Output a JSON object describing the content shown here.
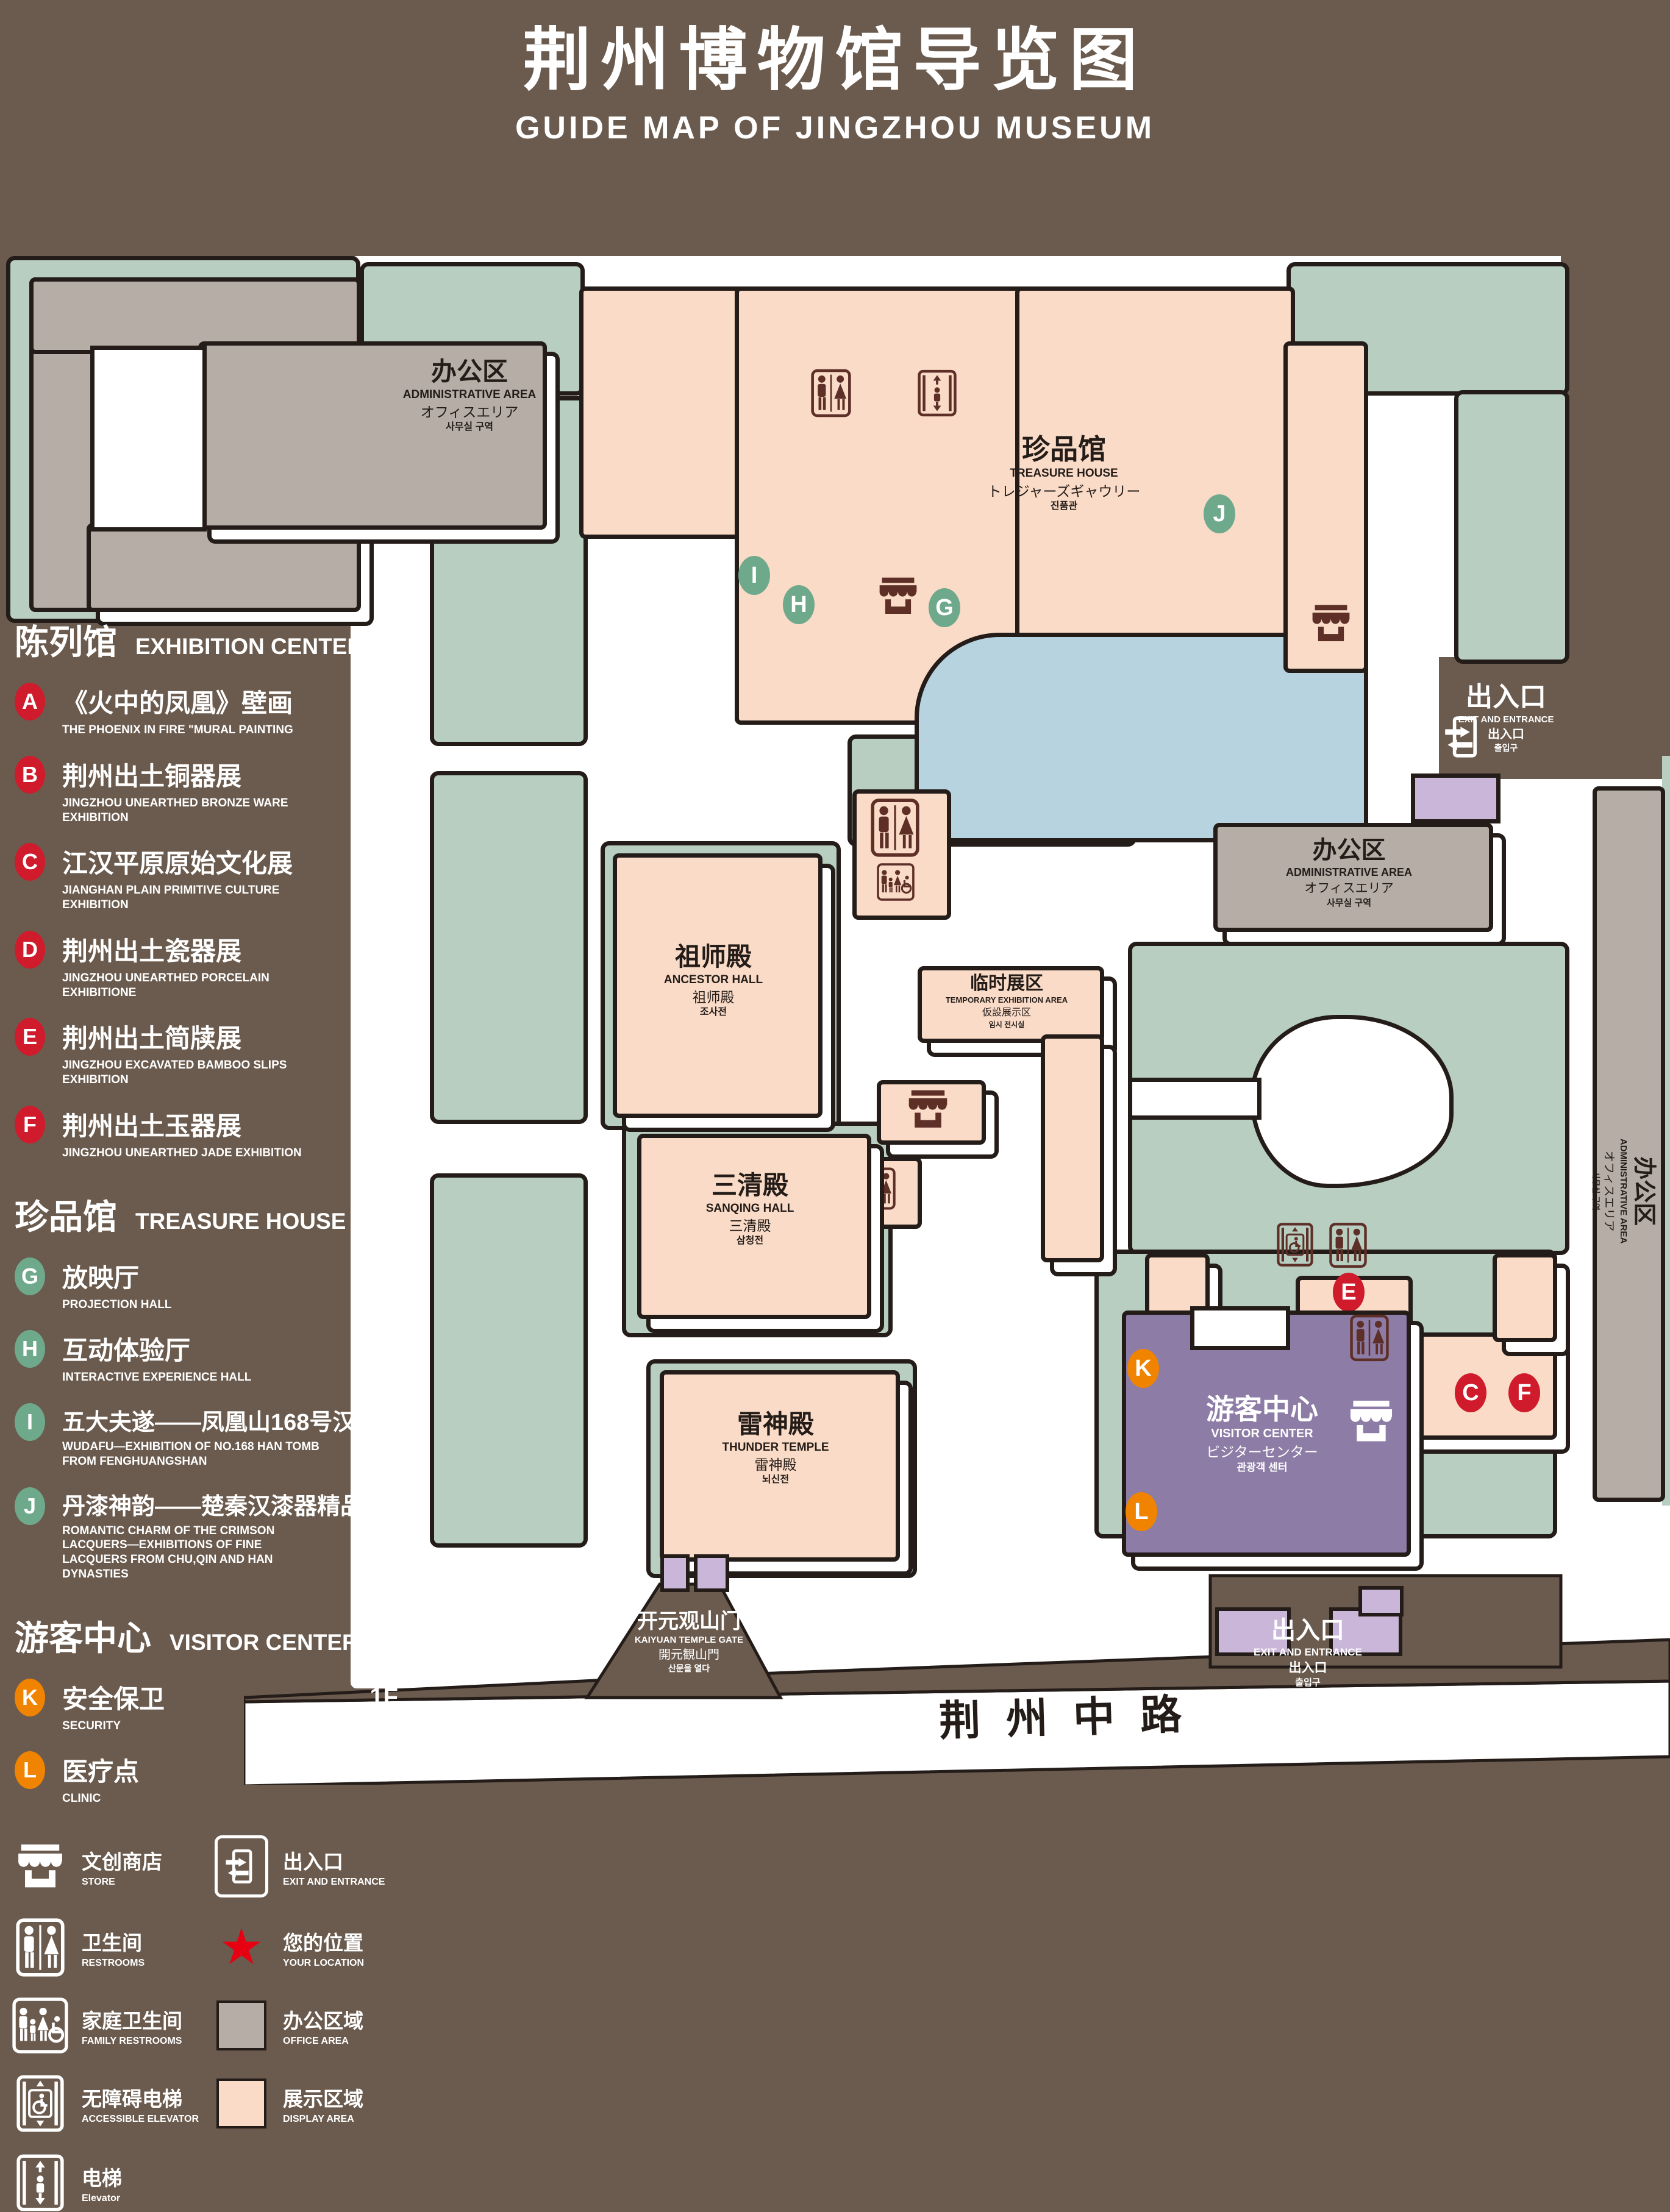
{
  "title": {
    "cn": "荆州博物馆导览图",
    "en": "GUIDE MAP OF JINGZHOU MUSEUM"
  },
  "legend": {
    "sections": [
      {
        "cn": "陈列馆",
        "en": "EXHIBITION CENTER",
        "items": [
          {
            "letter": "A",
            "cn": "《火中的凤凰》壁画",
            "en": "THE PHOENIX IN FIRE \"MURAL PAINTING",
            "floor": "1F"
          },
          {
            "letter": "B",
            "cn": "荆州出土铜器展",
            "en": "JINGZHOU UNEARTHED BRONZE WARE EXHIBITION",
            "floor": "1F"
          },
          {
            "letter": "C",
            "cn": "江汉平原原始文化展",
            "en": "JIANGHAN PLAIN PRIMITIVE CULTURE EXHIBITION",
            "floor": "1F"
          },
          {
            "letter": "D",
            "cn": "荆州出土瓷器展",
            "en": "JINGZHOU UNEARTHED PORCELAIN EXHIBITIONE",
            "floor": "2F"
          },
          {
            "letter": "E",
            "cn": "荆州出土简牍展",
            "en": "JINGZHOU EXCAVATED BAMBOO SLIPS EXHIBITION",
            "floor": "2F"
          },
          {
            "letter": "F",
            "cn": "荆州出土玉器展",
            "en": "JINGZHOU UNEARTHED JADE EXHIBITION",
            "floor": "2F"
          }
        ]
      },
      {
        "cn": "珍品馆",
        "en": "TREASURE HOUSE",
        "items": [
          {
            "letter": "G",
            "cn": "放映厅",
            "en": "PROJECTION HALL",
            "floor": "1F"
          },
          {
            "letter": "H",
            "cn": "互动体验厅",
            "en": "INTERACTIVE EXPERIENCE HALL",
            "floor": "1F"
          },
          {
            "letter": "I",
            "cn": "五大夫遂——凤凰山168号汉墓展",
            "en": "WUDAFU—EXHIBITION OF NO.168 HAN TOMB FROM FENGHUANGSHAN",
            "floor": "2F"
          },
          {
            "letter": "J",
            "cn": "丹漆神韵——楚秦汉漆器精品展",
            "en": "ROMANTIC CHARM OF THE CRIMSON LACQUERS—EXHIBITIONS OF FINE LACQUERS FROM CHU,QIN AND HAN DYNASTIES",
            "floor": "1-2F"
          }
        ]
      },
      {
        "cn": "游客中心",
        "en": "VISITOR CENTER",
        "items": [
          {
            "letter": "K",
            "cn": "安全保卫",
            "en": "SECURITY",
            "floor": "1F"
          },
          {
            "letter": "L",
            "cn": "医疗点",
            "en": "CLINIC",
            "floor": "1F"
          }
        ]
      }
    ],
    "symbols": [
      {
        "icon": "store-icon",
        "cn": "文创商店",
        "en": "STORE"
      },
      {
        "icon": "exit-icon",
        "cn": "出入口",
        "en": "EXIT AND ENTRANCE"
      },
      {
        "icon": "restrooms-icon",
        "cn": "卫生间",
        "en": "RESTROOMS"
      },
      {
        "icon": "your-location-star",
        "cn": "您的位置",
        "en": "YOUR LOCATION",
        "color": "#e60012"
      },
      {
        "icon": "family-restrooms-icon",
        "cn": "家庭卫生间",
        "en": "FAMILY RESTROOMS"
      },
      {
        "icon": "office-area-swatch",
        "cn": "办公区域",
        "en": "OFFICE AREA",
        "color": "#b5ada6"
      },
      {
        "icon": "accessible-elevator-icon",
        "cn": "无障碍电梯",
        "en": "ACCESSIBLE ELEVATOR"
      },
      {
        "icon": "display-area-swatch",
        "cn": "展示区域",
        "en": "DISPLAY AREA",
        "color": "#f9dbc7"
      },
      {
        "icon": "elevator-icon",
        "cn": "电梯",
        "en": "Elevator"
      }
    ]
  },
  "map": {
    "buildings": {
      "admin": {
        "cn": "办公区",
        "en": "ADMINISTRATIVE AREA",
        "jp": "オフィスエリア",
        "kr": "사무실 구역"
      },
      "treasure": {
        "cn": "珍品馆",
        "en": "TREASURE HOUSE",
        "jp": "トレジャーズギャウリー",
        "kr": "진품관"
      },
      "ancestor": {
        "cn": "祖师殿",
        "en": "ANCESTOR HALL",
        "jp": "祖师殿",
        "kr": "조사전"
      },
      "temporary": {
        "cn": "临时展区",
        "en": "TEMPORARY EXHIBITION AREA",
        "jp": "仮設展示区",
        "kr": "임시 전시실"
      },
      "sanqing": {
        "cn": "三清殿",
        "en": "SANQING HALL",
        "jp": "三清殿",
        "kr": "삼청전"
      },
      "thunder": {
        "cn": "雷神殿",
        "en": "THUNDER TEMPLE",
        "jp": "雷神殿",
        "kr": "뇌신전"
      },
      "visitor": {
        "cn": "游客中心",
        "en": "VISITOR CENTER",
        "jp": "ビジターセンター",
        "kr": "관광객 센터"
      },
      "exhibition": {
        "cn": "陈列馆",
        "en": "EXHIBITION CENTER",
        "jp": "展示",
        "kr": "ホール 진열관"
      },
      "gate": {
        "cn": "开元观山门",
        "en": "KAIYUAN TEMPLE GATE",
        "jp": "開元観山門",
        "kr": "산문을 열다"
      }
    },
    "exit": {
      "cn": "出入口",
      "en": "EXIT AND ENTRANCE",
      "cn2": "出入口",
      "kr": "출입구"
    },
    "road": "荆州中路",
    "your_location": "您的位置",
    "badges": {
      "A": "A",
      "B": "B",
      "C": "C",
      "D": "D",
      "E": "E",
      "F": "F",
      "G": "G",
      "H": "H",
      "I": "I",
      "J": "J",
      "K": "K",
      "L": "L"
    }
  },
  "colors": {
    "background": "#6b5b4e",
    "lawn": "#b7cec0",
    "display_area": "#f9dbc7",
    "office_area": "#b5ada6",
    "visitor_center": "#8d7ca6",
    "gate_purple": "#c9b6d8",
    "pond": "#b7d3df",
    "marker_red": "#cf1b2b",
    "marker_green": "#6fa98c",
    "marker_orange": "#f08300",
    "icon_maroon": "#5d2f27",
    "location_red": "#e60012"
  }
}
